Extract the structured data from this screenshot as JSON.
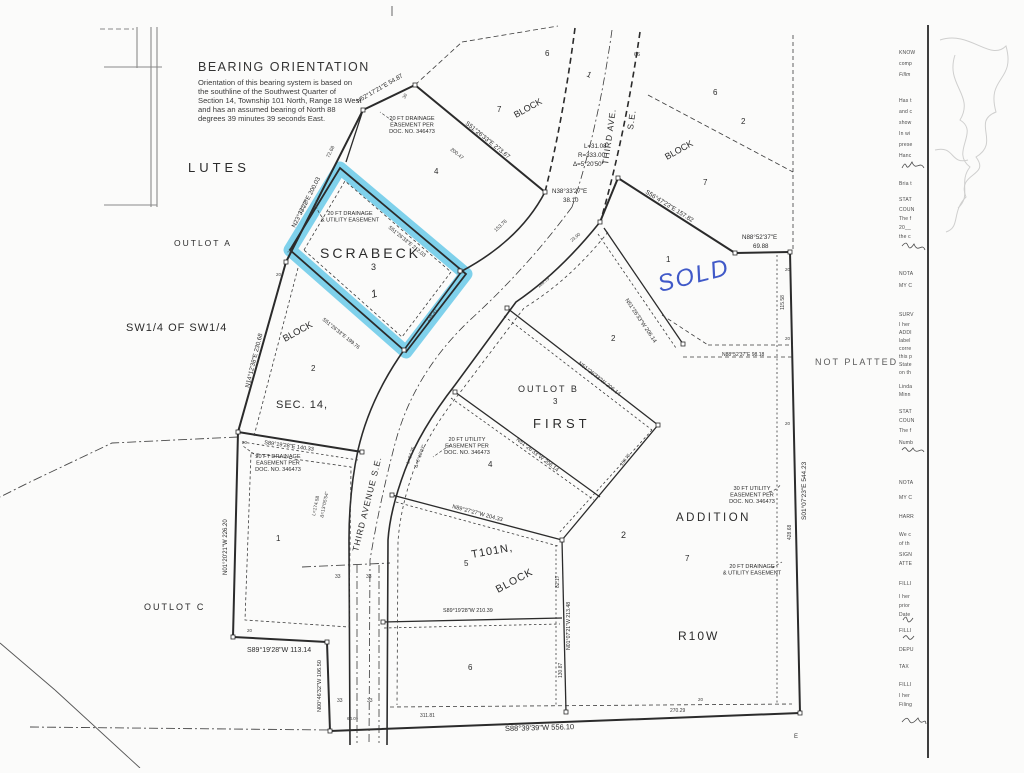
{
  "colors": {
    "ink": "#2b2b2b",
    "faint": "#777777",
    "highlight": "#56c3e6",
    "hand_blue": "#4059c8",
    "tick": "#3a3a3a",
    "gray_label": "#5a5a5a"
  },
  "bearing_note": {
    "heading": "BEARING ORIENTATION",
    "lines": [
      "Orientation of this bearing system is based on",
      "the southline of the Southwest Quarter of",
      "Section 14, Township 101 North, Range 18 West",
      "and has an assumed bearing of North 88",
      "degrees 39 minutes 39 seconds East."
    ]
  },
  "plat": {
    "area_labels": [
      {
        "t": "LUTES",
        "x": 188,
        "y": 172,
        "fs": 13,
        "sp": 4
      },
      {
        "t": "OUTLOT  A",
        "x": 174,
        "y": 246,
        "fs": 8.5,
        "sp": 2
      },
      {
        "t": "SW1/4  OF  SW1/4",
        "x": 126,
        "y": 331,
        "fs": 11,
        "sp": 1
      },
      {
        "t": "SCRABECK",
        "x": 320,
        "y": 258,
        "fs": 14,
        "sp": 3
      },
      {
        "t": "3",
        "x": 371,
        "y": 270,
        "fs": 9
      },
      {
        "t": "1",
        "x": 372,
        "y": 298,
        "fs": 11,
        "rot": -15,
        "i": true
      },
      {
        "t": "BLOCK",
        "x": 285,
        "y": 342,
        "fs": 9.5,
        "rot": -29
      },
      {
        "t": "2",
        "x": 311,
        "y": 371,
        "fs": 8
      },
      {
        "t": "SEC.  14,",
        "x": 276,
        "y": 408,
        "fs": 11,
        "sp": 1
      },
      {
        "t": "OUTLOT   C",
        "x": 144,
        "y": 610,
        "fs": 9,
        "sp": 2
      },
      {
        "t": "1",
        "x": 276,
        "y": 541,
        "fs": 8
      },
      {
        "t": "OUTLOT   B",
        "x": 518,
        "y": 392,
        "fs": 9,
        "sp": 2
      },
      {
        "t": "3",
        "x": 553,
        "y": 404,
        "fs": 8
      },
      {
        "t": "FIRST",
        "x": 533,
        "y": 428,
        "fs": 13,
        "sp": 4
      },
      {
        "t": "4",
        "x": 488,
        "y": 467,
        "fs": 8
      },
      {
        "t": "4",
        "x": 434,
        "y": 174,
        "fs": 8
      },
      {
        "t": "2",
        "x": 611,
        "y": 341,
        "fs": 8
      },
      {
        "t": "1",
        "x": 666,
        "y": 262,
        "fs": 8
      },
      {
        "t": "2",
        "x": 621,
        "y": 538,
        "fs": 9
      },
      {
        "t": "7",
        "x": 685,
        "y": 561,
        "fs": 8
      },
      {
        "t": "ADDITION",
        "x": 676,
        "y": 521,
        "fs": 11.5,
        "sp": 2.5
      },
      {
        "t": "R10W",
        "x": 678,
        "y": 640,
        "fs": 12,
        "sp": 2
      },
      {
        "t": "T101N,",
        "x": 472,
        "y": 558,
        "fs": 11,
        "rot": -10,
        "sp": 1
      },
      {
        "t": "BLOCK",
        "x": 498,
        "y": 593,
        "fs": 10.5,
        "rot": -28,
        "sp": 1
      },
      {
        "t": "5",
        "x": 464,
        "y": 566,
        "fs": 8
      },
      {
        "t": "6",
        "x": 468,
        "y": 670,
        "fs": 8
      },
      {
        "t": "6",
        "x": 545,
        "y": 56,
        "fs": 8
      },
      {
        "t": "7",
        "x": 497,
        "y": 112,
        "fs": 8
      },
      {
        "t": "BLOCK",
        "x": 516,
        "y": 118,
        "fs": 9,
        "rot": -29
      },
      {
        "t": "1",
        "x": 586,
        "y": 76,
        "fs": 8,
        "rot": 25
      },
      {
        "t": "6",
        "x": 713,
        "y": 95,
        "fs": 8
      },
      {
        "t": "2",
        "x": 741,
        "y": 124,
        "fs": 8
      },
      {
        "t": "BLOCK",
        "x": 667,
        "y": 160,
        "fs": 9,
        "rot": -29
      },
      {
        "t": "7",
        "x": 703,
        "y": 185,
        "fs": 8
      },
      {
        "t": "NOT  PLATTED",
        "x": 815,
        "y": 365,
        "fs": 9,
        "sp": 2,
        "c": "#5a5a5a"
      }
    ],
    "road_labels": [
      {
        "t": "THIRD  AVE.",
        "x": 608,
        "y": 165,
        "fs": 8.5,
        "rot": -82,
        "sp": 1
      },
      {
        "t": "S.E.",
        "x": 633,
        "y": 130,
        "fs": 8.5,
        "rot": -82,
        "sp": 1
      },
      {
        "t": "THIRD  AVENUE  S.E.",
        "x": 358,
        "y": 552,
        "fs": 8.5,
        "rot": -76,
        "sp": 1
      }
    ],
    "bearing_labels": [
      {
        "t": "N52°17'21\"E  54.87",
        "x": 358,
        "y": 103,
        "rot": -30
      },
      {
        "t": "S51°26'33\"E  273.67",
        "x": 465,
        "y": 124,
        "rot": 39
      },
      {
        "t": "N23°33'22\"E  200.03",
        "x": 295,
        "y": 228,
        "rot": -63
      },
      {
        "t": "N38°33'27\"E",
        "x": 552,
        "y": 193
      },
      {
        "t": "38.10",
        "x": 563,
        "y": 202
      },
      {
        "t": "L=31.08",
        "x": 584,
        "y": 148
      },
      {
        "t": "R=333.00",
        "x": 578,
        "y": 157
      },
      {
        "t": "Δ=5°20'50\"",
        "x": 573,
        "y": 166
      },
      {
        "t": "S56°47'23\"E  157.82",
        "x": 645,
        "y": 193,
        "rot": 32
      },
      {
        "t": "N88°52'37\"E",
        "x": 742,
        "y": 239
      },
      {
        "t": "69.88",
        "x": 753,
        "y": 248
      },
      {
        "t": "N14°12'38\"E  230.68",
        "x": 249,
        "y": 388,
        "rot": -76
      },
      {
        "t": "S89°19'28\"E  140.33",
        "x": 264,
        "y": 444,
        "rot": 8,
        "fs": 5.6
      },
      {
        "t": "N01°20'21\"W  226.20",
        "x": 227,
        "y": 575,
        "rot": -90,
        "fs": 6
      },
      {
        "t": "S89°19'28\"W   113.14",
        "x": 247,
        "y": 652,
        "fs": 7
      },
      {
        "t": "N00°46'32\"W  106.50",
        "x": 321,
        "y": 712,
        "rot": -90,
        "fs": 5.6
      },
      {
        "t": "S88°39'39\"W  556.10",
        "x": 505,
        "y": 731,
        "fs": 7.5,
        "rot": -1.5
      },
      {
        "t": "S01°07'23\"E  544.23",
        "x": 806,
        "y": 520,
        "rot": -90,
        "fs": 6.5
      },
      {
        "t": "N51°26'33\"W  206.14",
        "x": 578,
        "y": 364,
        "rot": 38,
        "fs": 5.6
      },
      {
        "t": "N51°26'33\"W  206.14",
        "x": 516,
        "y": 440,
        "rot": 38,
        "fs": 5.6
      },
      {
        "t": "N51°26'33\"W  206.14",
        "x": 625,
        "y": 300,
        "rot": 56,
        "fs": 5.6
      },
      {
        "t": "N89°27'27\"W  204.33",
        "x": 452,
        "y": 508,
        "rot": 15,
        "fs": 5.6
      },
      {
        "t": "S89°19'28\"W  210.39",
        "x": 443,
        "y": 612,
        "fs": 5.4
      },
      {
        "t": "N88°52'37\"E  98.18",
        "x": 722,
        "y": 356,
        "fs": 5
      },
      {
        "t": "N01°07'21\"W  213.48",
        "x": 570,
        "y": 650,
        "rot": -90,
        "fs": 5.2
      },
      {
        "t": "S51°26'33\"E  212.03",
        "x": 388,
        "y": 228,
        "rot": 39,
        "fs": 5.2
      },
      {
        "t": "S51°26'33\"E  199.76",
        "x": 322,
        "y": 320,
        "rot": 39,
        "fs": 5.2
      }
    ],
    "tick_labels": [
      {
        "t": "115.58",
        "x": 784,
        "y": 310,
        "rot": -90
      },
      {
        "t": "428.68",
        "x": 791,
        "y": 540,
        "rot": -90
      },
      {
        "t": "82.17",
        "x": 559,
        "y": 588,
        "rot": -90
      },
      {
        "t": "130.87",
        "x": 562,
        "y": 678,
        "rot": -90
      },
      {
        "t": "311.81",
        "x": 420,
        "y": 717
      },
      {
        "t": "270.29",
        "x": 670,
        "y": 712
      },
      {
        "t": "72.68",
        "x": 329,
        "y": 158,
        "rot": -63
      },
      {
        "t": "200.47",
        "x": 450,
        "y": 150,
        "rot": 39
      },
      {
        "t": "138.41",
        "x": 428,
        "y": 322,
        "rot": -51
      },
      {
        "t": "122.75",
        "x": 301,
        "y": 214,
        "rot": -63
      },
      {
        "t": "153.76",
        "x": 496,
        "y": 232,
        "rot": -43
      },
      {
        "t": "160.75",
        "x": 622,
        "y": 466,
        "rot": -52,
        "fs": 4.5
      },
      {
        "t": "160.75",
        "x": 539,
        "y": 288,
        "rot": -40,
        "fs": 4.5
      },
      {
        "t": "23.90",
        "x": 572,
        "y": 242,
        "rot": -40,
        "fs": 4.5
      },
      {
        "t": "L=174.58",
        "x": 315,
        "y": 516,
        "rot": -78,
        "fs": 4.8
      },
      {
        "t": "Δ=13°05'54\"",
        "x": 323,
        "y": 518,
        "rot": -78,
        "fs": 4.8
      },
      {
        "t": "L=84.35",
        "x": 409,
        "y": 464,
        "rot": -70,
        "fs": 4.8
      },
      {
        "t": "Δ=6°18'23\"",
        "x": 417,
        "y": 468,
        "rot": -70,
        "fs": 4.8
      },
      {
        "t": "64.09",
        "x": 347,
        "y": 720,
        "fs": 4.5
      },
      {
        "t": "33",
        "x": 335,
        "y": 578
      },
      {
        "t": "33",
        "x": 366,
        "y": 578
      },
      {
        "t": "33",
        "x": 337,
        "y": 702
      },
      {
        "t": "33",
        "x": 367,
        "y": 702
      },
      {
        "t": "66",
        "x": 634,
        "y": 56,
        "fs": 5.5
      },
      {
        "t": "30",
        "x": 405,
        "y": 99,
        "rot": -63,
        "fs": 4.5
      },
      {
        "t": "20",
        "x": 290,
        "y": 254,
        "rot": -63,
        "fs": 4.5
      },
      {
        "t": "20",
        "x": 276,
        "y": 276,
        "fs": 4.5
      },
      {
        "t": "20",
        "x": 242,
        "y": 444,
        "fs": 4.5
      },
      {
        "t": "20",
        "x": 247,
        "y": 632,
        "fs": 4.5
      },
      {
        "t": "20",
        "x": 785,
        "y": 271,
        "fs": 4.5
      },
      {
        "t": "20",
        "x": 785,
        "y": 340,
        "fs": 4.5
      },
      {
        "t": "20",
        "x": 785,
        "y": 425,
        "fs": 4.5
      },
      {
        "t": "20",
        "x": 698,
        "y": 701,
        "fs": 4.5
      },
      {
        "t": "E",
        "x": 794,
        "y": 738,
        "fs": 6
      }
    ],
    "easement_notes": [
      {
        "x": 412,
        "y": 120,
        "lines": [
          "20 FT DRAINAGE",
          "EASEMENT PER",
          "DOC. NO. 346473"
        ]
      },
      {
        "x": 350,
        "y": 215,
        "lines": [
          "20 FT DRAINAGE",
          "& UTILITY EASEMENT"
        ]
      },
      {
        "x": 278,
        "y": 458,
        "lines": [
          "20 FT DRAINAGE",
          "EASEMENT PER",
          "DOC. NO. 346473"
        ]
      },
      {
        "x": 467,
        "y": 441,
        "lines": [
          "20 FT UTILITY",
          "EASEMENT PER",
          "DOC. NO. 346473"
        ]
      },
      {
        "x": 752,
        "y": 490,
        "lines": [
          "30 FT UTILITY",
          "EASEMENT PER",
          "DOC. NO. 346473"
        ]
      },
      {
        "x": 752,
        "y": 568,
        "lines": [
          "20 FT DRAINAGE",
          "& UTILITY EASEMENT"
        ]
      }
    ],
    "handwritten_sold": {
      "text": "SOLD",
      "x": 660,
      "y": 292,
      "rot": -14,
      "fs": 24
    }
  },
  "margin": {
    "fragments": [
      {
        "y": 50,
        "t": "KNOW"
      },
      {
        "y": 61,
        "t": "comp"
      },
      {
        "y": 72,
        "t": "Fillm",
        "i": true
      },
      {
        "y": 98,
        "t": "Has t"
      },
      {
        "y": 109,
        "t": "and c"
      },
      {
        "y": 120,
        "t": "show"
      },
      {
        "y": 131,
        "t": "In wi"
      },
      {
        "y": 142,
        "t": "prese"
      },
      {
        "y": 153,
        "t": "Hanc"
      },
      {
        "y": 181,
        "t": "Bria t"
      },
      {
        "y": 197,
        "t": "STAT"
      },
      {
        "y": 207,
        "t": "COUN"
      },
      {
        "y": 216,
        "t": "The f"
      },
      {
        "y": 225,
        "t": "20__"
      },
      {
        "y": 234,
        "t": "the c"
      },
      {
        "y": 271,
        "t": "NOTA"
      },
      {
        "y": 283,
        "t": "MY C"
      },
      {
        "y": 312,
        "t": "SURV"
      },
      {
        "y": 322,
        "t": "I her"
      },
      {
        "y": 330,
        "t": "ADDI"
      },
      {
        "y": 338,
        "t": "label"
      },
      {
        "y": 346,
        "t": "corre"
      },
      {
        "y": 354,
        "t": "this p"
      },
      {
        "y": 362,
        "t": "State"
      },
      {
        "y": 370,
        "t": "on th"
      },
      {
        "y": 384,
        "t": "Linda"
      },
      {
        "y": 392,
        "t": "Minn"
      },
      {
        "y": 409,
        "t": "STAT"
      },
      {
        "y": 418,
        "t": "COUN"
      },
      {
        "y": 428,
        "t": "The f"
      },
      {
        "y": 440,
        "t": "Numb"
      },
      {
        "y": 480,
        "t": "NOTA"
      },
      {
        "y": 495,
        "t": "MY C"
      },
      {
        "y": 514,
        "t": "HARR"
      },
      {
        "y": 532,
        "t": "We c"
      },
      {
        "y": 541,
        "t": "of th"
      },
      {
        "y": 552,
        "t": "SIGN"
      },
      {
        "y": 561,
        "t": "ATTE"
      },
      {
        "y": 581,
        "t": "FILLI"
      },
      {
        "y": 594,
        "t": "I her"
      },
      {
        "y": 603,
        "t": "prior"
      },
      {
        "y": 612,
        "t": "Date"
      },
      {
        "y": 628,
        "t": "FILLI"
      },
      {
        "y": 647,
        "t": "DEPU"
      },
      {
        "y": 664,
        "t": "TAX"
      },
      {
        "y": 682,
        "t": "FILLI"
      },
      {
        "y": 693,
        "t": "I her"
      },
      {
        "y": 702,
        "t": "Filing"
      }
    ]
  }
}
